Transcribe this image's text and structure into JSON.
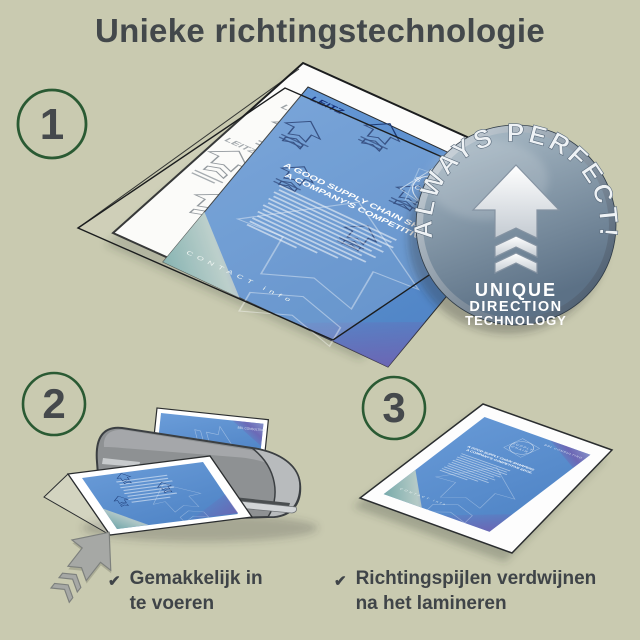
{
  "title": "Unieke richtingstechnologie",
  "steps": {
    "one": "1",
    "two": "2",
    "three": "3"
  },
  "badge": {
    "arc_text": "ALWAYS PERFECT!",
    "line1": "UNIQUE",
    "line2": "DIRECTION",
    "line3": "TECHNOLOGY"
  },
  "flyer": {
    "brand": "LEITZ",
    "company": "BBL CONSULTING",
    "logo_line1": "SUPPLY",
    "logo_line2": "CHAIN",
    "headline1": "A GOOD SUPPLY CHAIN SHARPENS",
    "headline2": "A COMPANY'S COMPETITIVE EDGE.",
    "contact": "CONTACT info"
  },
  "captions": {
    "one": {
      "mark": "✔",
      "line1": "Gemakkelijk in",
      "line2": "te voeren"
    },
    "two": {
      "mark": "✔",
      "line1": "Richtingspijlen verdwijnen",
      "line2": "na het lamineren"
    }
  },
  "colors": {
    "background": "#c9cab0",
    "title_text": "#43484b",
    "step_ring": "#2a5a33",
    "step_number": "#45494c",
    "flyer_blue": "#5e93d2",
    "laminator_gray": "#8e9193",
    "badge_metal": "#7e93a6",
    "caption_text": "#3f4448"
  }
}
